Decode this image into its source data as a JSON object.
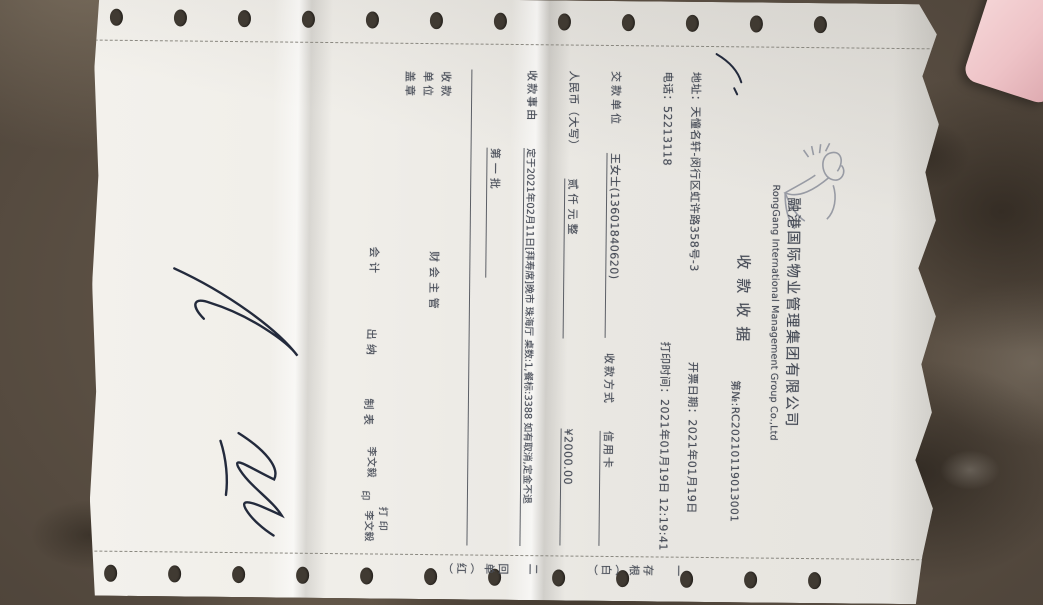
{
  "scene": {
    "surface": "granite-countertop",
    "pink_object": "pink-item-corner",
    "paper_color": "#e9e7e2",
    "granite_color": "#5a4f43",
    "ink_color": "#474c57"
  },
  "receipt": {
    "logo_icon": "swan-flourish-logo",
    "company_cn": "融港国际物业管理集团有限公司",
    "company_en": "RongGang International Management Group Co.,Ltd",
    "title": "收款收据",
    "doc_no_label": "第№:",
    "doc_no": "RC20210119013001",
    "address_label": "地址：",
    "address": "天憧名轩-闵行区虹许路358号-3",
    "phone_label": "电话：",
    "phone": "52213118",
    "invoice_date_label": "开票日期：",
    "invoice_date": "2021年01月19日",
    "print_time_label": "打印时间：",
    "print_time": "2021年01月19日 12:19:41",
    "payer_label": "交款单位",
    "payer": "王女士(13601840620)",
    "method_label": "收款方式",
    "method": "信用卡",
    "amount_words_label": "人民币（大写）",
    "amount_words": "贰仟元整",
    "amount_figures": "¥2000.00",
    "reason_label": "收款事由",
    "reason": "定于2021年02月11日[拜寿席]晚市 珠海厅 桌数:1,餐标:3388 如有取消,定金不退",
    "reason_line2": "第一批",
    "footer": {
      "unit_line1": "收款",
      "unit_line2": "单位",
      "unit_line3": "盖章",
      "fin_supervisor": "财 会 主 管",
      "accountant": "会  计",
      "cashier": "出  纳",
      "preparer_label": "制  表",
      "preparer_name": "李文毅",
      "seal_char": "印",
      "printer_label": "打 印",
      "printer_name": "李文毅"
    },
    "copy_strip": {
      "line1": "一 存根（白）",
      "line2": "二 回单（红）"
    }
  }
}
